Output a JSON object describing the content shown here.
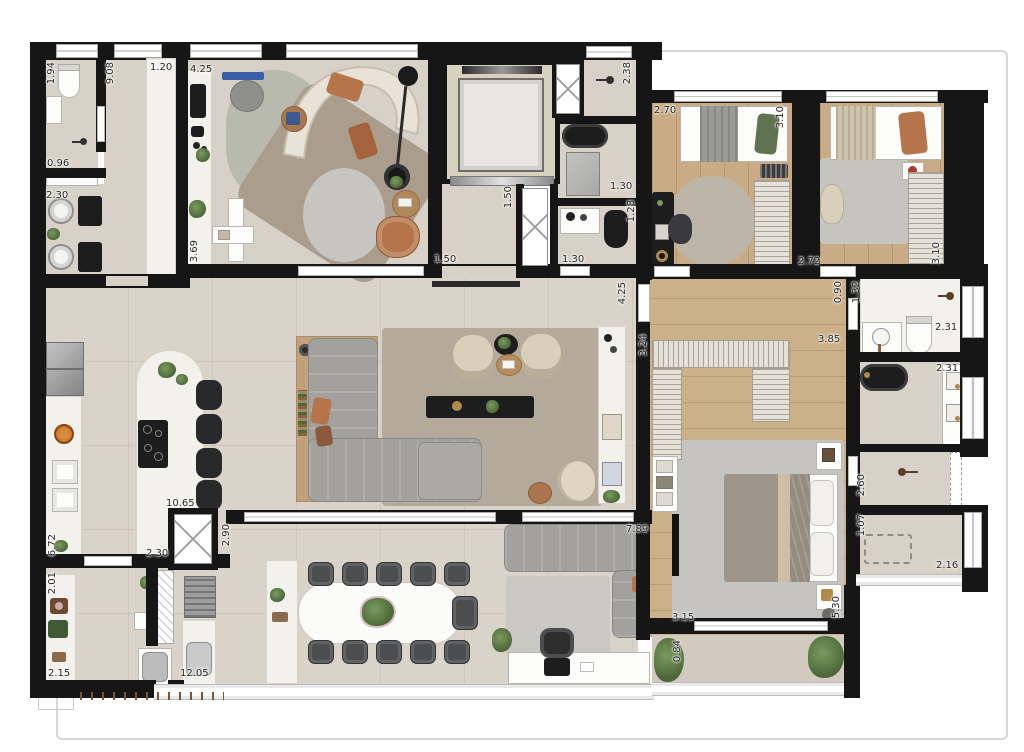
{
  "dims": [
    {
      "v": "1.94"
    },
    {
      "v": "0.96"
    },
    {
      "v": "2.30"
    },
    {
      "v": "9.08"
    },
    {
      "v": "1.20"
    },
    {
      "v": "4.25"
    },
    {
      "v": "3.69"
    },
    {
      "v": "2.38"
    },
    {
      "v": "1.50"
    },
    {
      "v": "1.50"
    },
    {
      "v": "1.30"
    },
    {
      "v": "1.28"
    },
    {
      "v": "1.30"
    },
    {
      "v": "2.70"
    },
    {
      "v": "3.10"
    },
    {
      "v": "2.72"
    },
    {
      "v": "3.10"
    },
    {
      "v": "0.90"
    },
    {
      "v": "1.32"
    },
    {
      "v": "2.31"
    },
    {
      "v": "2.31"
    },
    {
      "v": "2.60"
    },
    {
      "v": "1.07"
    },
    {
      "v": "2.16"
    },
    {
      "v": "3.24"
    },
    {
      "v": "3.85"
    },
    {
      "v": "4.25"
    },
    {
      "v": "7.89"
    },
    {
      "v": "3.15"
    },
    {
      "v": "5.30"
    },
    {
      "v": "0.84"
    },
    {
      "v": "10.65"
    },
    {
      "v": "6.72"
    },
    {
      "v": "2.30"
    },
    {
      "v": "2.90"
    },
    {
      "v": "2.01"
    },
    {
      "v": "2.15"
    },
    {
      "v": "12.05"
    }
  ],
  "colors": {
    "wall": "#161616",
    "floor_tile": "#dad3c9",
    "wood": "#c9ac85",
    "marble": "#f3f1eb",
    "sofa_gray": "#a2a19d",
    "accent_caramel": "#b5744a",
    "greenery": "#5d7d49",
    "rug_living": "#b4aa9c",
    "fixture_black": "#1d1d1d"
  },
  "icons": {
    "duct-x": "diagonal-cross",
    "shower-head": "dot-with-arm",
    "cooktop": "black-panel-4-burners",
    "wardrobe": "hanger-hatch-lines",
    "window": "white-bar-center-line"
  }
}
